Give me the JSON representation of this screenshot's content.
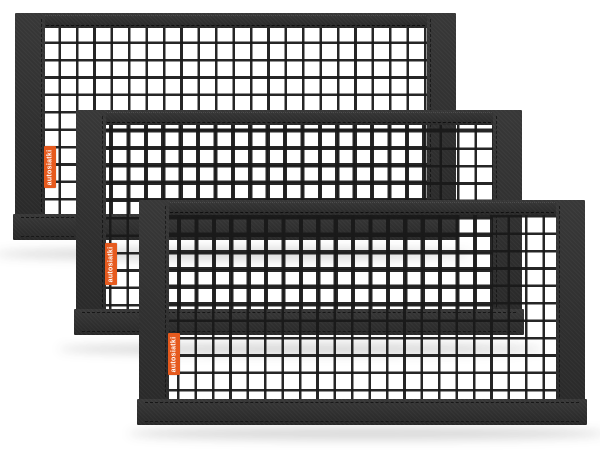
{
  "product": {
    "brand_label": "autosiatki",
    "net_count": 3,
    "colors": {
      "label_background": "#e65a1e",
      "label_text": "#ffffff",
      "frame": "#2d2d2d",
      "mesh": "#191919",
      "background": "#ffffff"
    }
  }
}
